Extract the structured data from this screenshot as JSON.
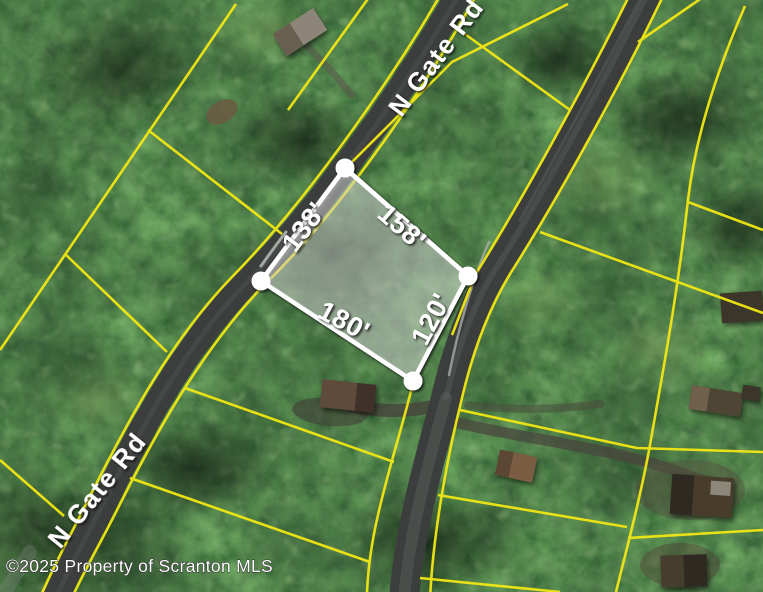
{
  "map": {
    "copyright": "©2025 Property of Scranton MLS",
    "roads": [
      {
        "id": "n-gate-rd-upper",
        "label": "N Gate Rd"
      },
      {
        "id": "n-gate-rd-lower",
        "label": "N Gate Rd"
      }
    ],
    "highlighted_lot": {
      "dimensions": [
        {
          "side": "northwest",
          "label": "138'"
        },
        {
          "side": "northeast",
          "label": "158'"
        },
        {
          "side": "south",
          "label": "180'"
        },
        {
          "side": "southeast",
          "label": "120'"
        }
      ]
    },
    "lot_fill_opacity": "0.33",
    "colors": {
      "parcel_line": "#f2e713",
      "lot_outline": "#ffffff",
      "road_asphalt": "#3b3e3c",
      "dimension_text": "#ffffff",
      "road_label_text": "#ffffff",
      "copyright_text": "#ffffff"
    }
  }
}
